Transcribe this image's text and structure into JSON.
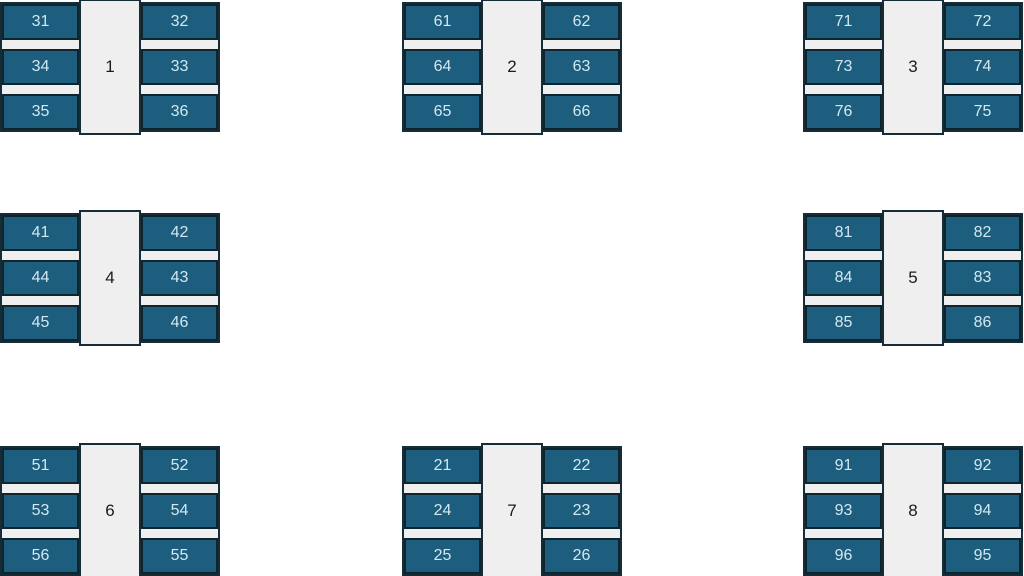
{
  "page": {
    "background_color": "#ffffff"
  },
  "colors": {
    "seat_fill": "#1d5e7e",
    "seat_text": "#d3e8f1",
    "seat_border": "#10242e",
    "desk_fill": "#efefef",
    "desk_border": "#152d38",
    "desk_text": "#1b1b1b"
  },
  "tables": [
    {
      "number": "1",
      "seats": [
        "31",
        "32",
        "34",
        "33",
        "35",
        "36"
      ]
    },
    {
      "number": "2",
      "seats": [
        "61",
        "62",
        "64",
        "63",
        "65",
        "66"
      ]
    },
    {
      "number": "3",
      "seats": [
        "71",
        "72",
        "73",
        "74",
        "76",
        "75"
      ]
    },
    {
      "number": "4",
      "seats": [
        "41",
        "42",
        "44",
        "43",
        "45",
        "46"
      ]
    },
    {
      "number": "5",
      "seats": [
        "81",
        "82",
        "84",
        "83",
        "85",
        "86"
      ]
    },
    {
      "number": "6",
      "seats": [
        "51",
        "52",
        "53",
        "54",
        "56",
        "55"
      ]
    },
    {
      "number": "7",
      "seats": [
        "21",
        "22",
        "24",
        "23",
        "25",
        "26"
      ]
    },
    {
      "number": "8",
      "seats": [
        "91",
        "92",
        "93",
        "94",
        "96",
        "95"
      ]
    }
  ]
}
